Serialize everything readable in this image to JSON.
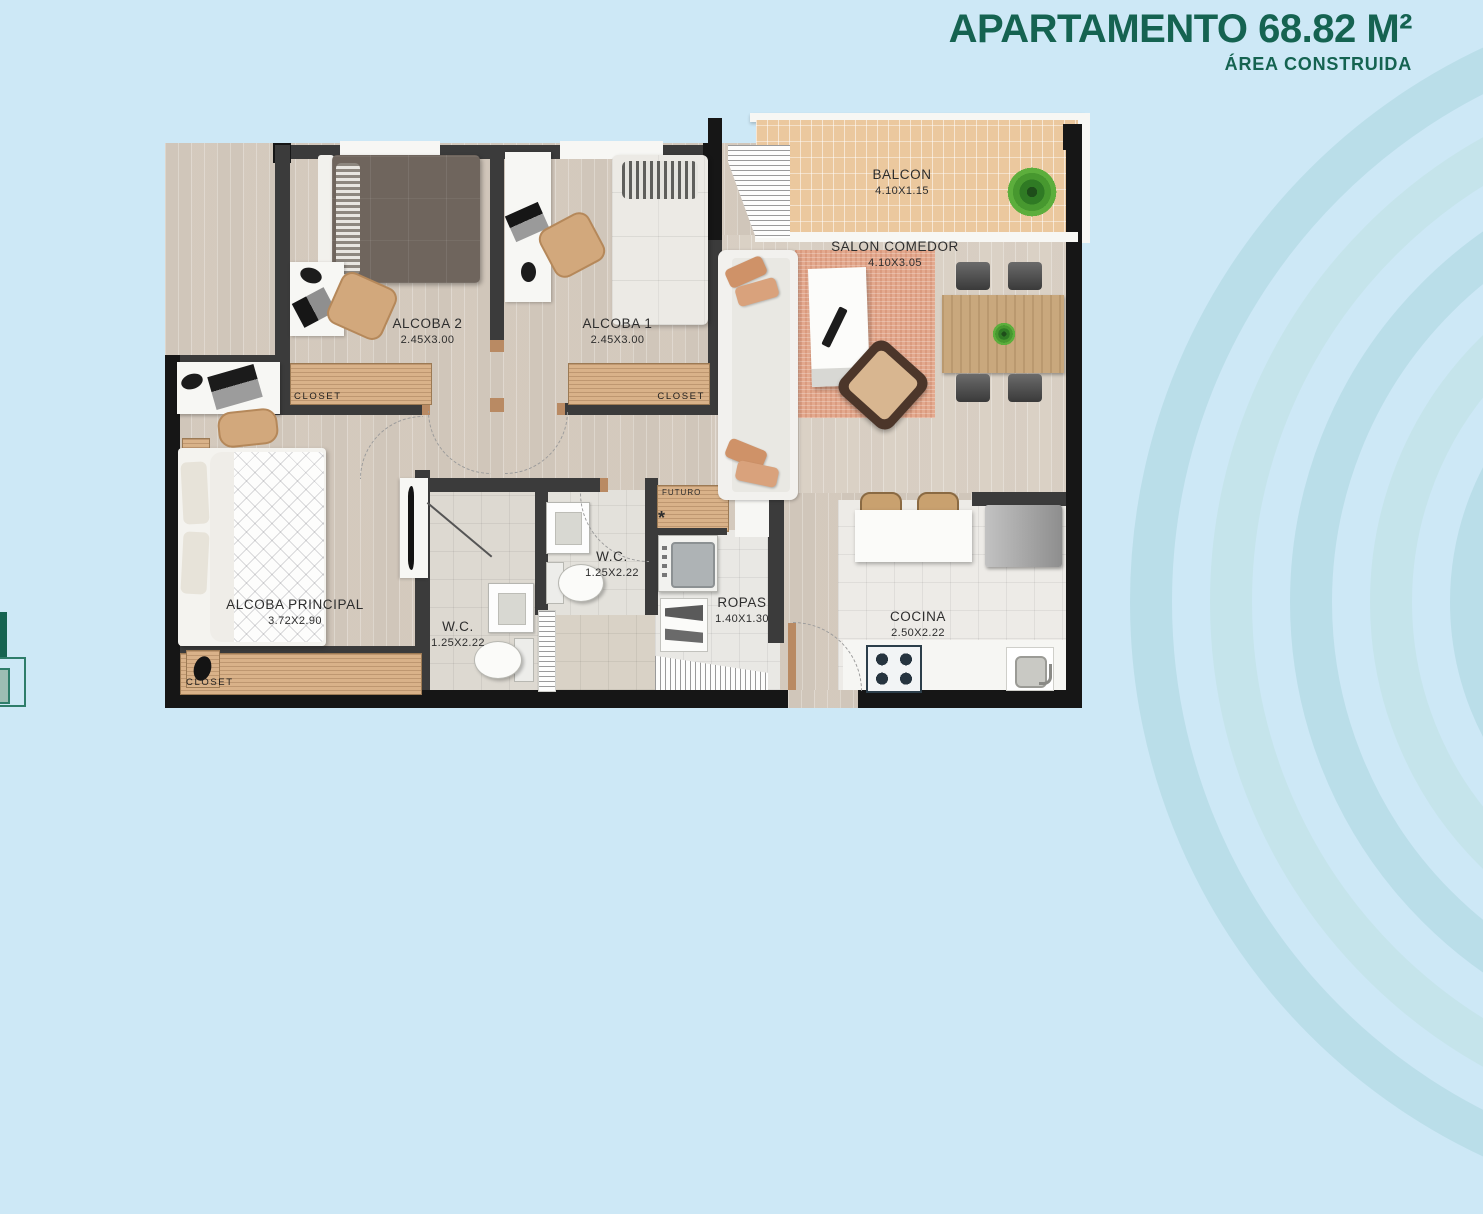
{
  "header": {
    "title": "APARTAMENTO 68.82 M²",
    "subtitle": "ÁREA CONSTRUIDA"
  },
  "rooms": {
    "balcon": {
      "name": "BALCON",
      "dims": "4.10X1.15"
    },
    "salon": {
      "name": "SALON COMEDOR",
      "dims": "4.10X3.05"
    },
    "alcoba2": {
      "name": "ALCOBA 2",
      "dims": "2.45X3.00"
    },
    "alcoba1": {
      "name": "ALCOBA 1",
      "dims": "2.45X3.00"
    },
    "principal": {
      "name": "ALCOBA PRINCIPAL",
      "dims": "3.72X2.90"
    },
    "wc_lower": {
      "name": "W.C.",
      "dims": "1.25X2.22"
    },
    "wc_upper": {
      "name": "W.C.",
      "dims": "1.25X2.22"
    },
    "ropas": {
      "name": "ROPAS",
      "dims": "1.40X1.30"
    },
    "cocina": {
      "name": "COCINA",
      "dims": "2.50X2.22"
    }
  },
  "labels": {
    "closet_alcoba2": "CLOSET",
    "closet_alcoba1": "CLOSET",
    "closet_principal": "CLOSET",
    "futuro": "FUTURO",
    "futuro_mark": "*"
  },
  "colors": {
    "background": "#cde8f6",
    "title_green": "#156351",
    "wall_dark": "#3b3b3b",
    "wood_floor": "#d7cec3",
    "closet_wood": "#d9b289",
    "balcony_tile": "#ebc89e",
    "rug_salmon": "#e3a98e",
    "label_text": "#2d2d2d"
  }
}
